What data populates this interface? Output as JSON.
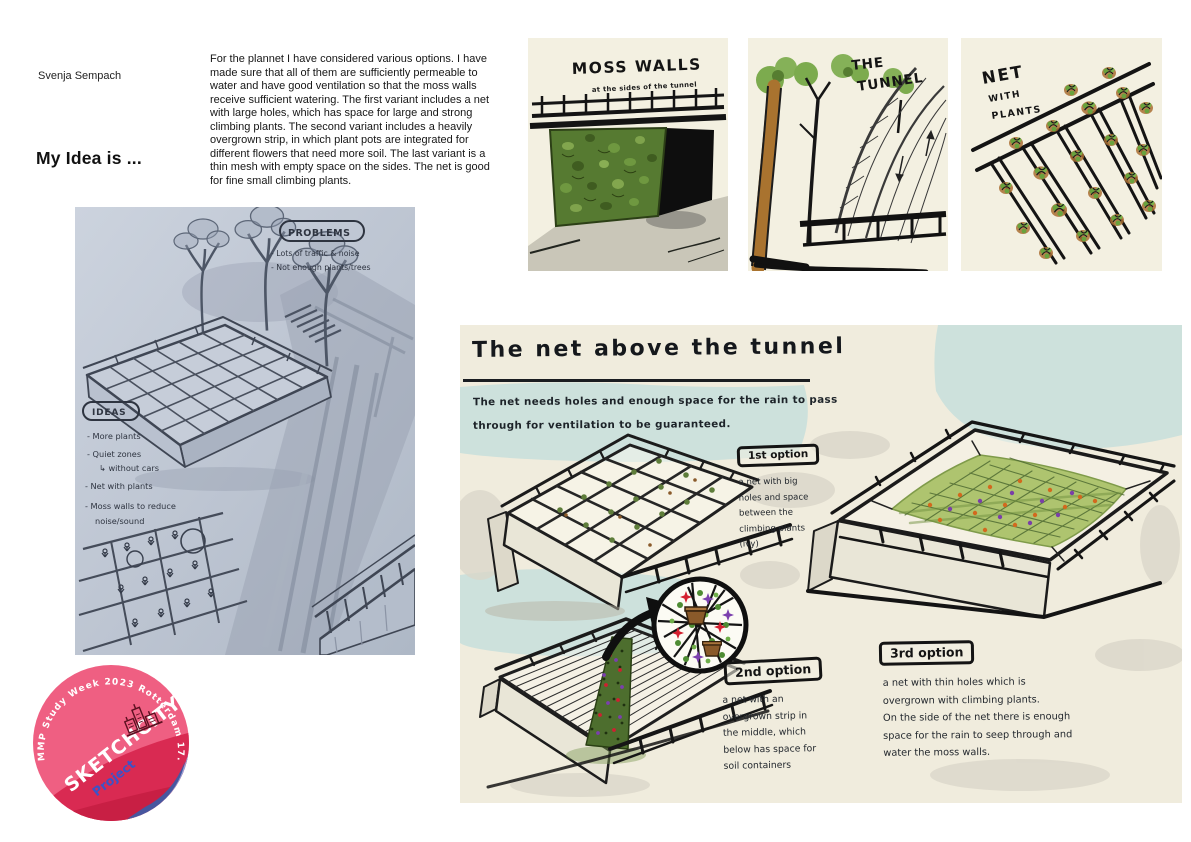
{
  "page": {
    "author": "Svenja Sempach",
    "heading": "My Idea is ...",
    "intro": "For the plannet I have considered various options. I have made sure that all of them are sufficiently permeable to water and have good ventilation so that the moss walls receive sufficient watering. The first variant includes a net with large holes, which has space for large and strong climbing plants. The second variant includes a heavily overgrown strip, in which plant pots are integrated for different flowers that need more soil. The last variant is a thin mesh with empty space on the sides. The net is good for fine small climbing plants."
  },
  "sketch": {
    "problems_title": "PROBLEMS",
    "problems": [
      "- Lots of traffic & noise",
      "- Not enough plants/trees"
    ],
    "ideas_title": "IDEAS",
    "ideas": [
      "- More plants",
      "- Quiet zones",
      "↳ without cars",
      "- Net with plants",
      "- Moss walls to reduce",
      "noise/sound"
    ]
  },
  "panels": {
    "moss": {
      "title": "MOSS WALLS",
      "subtitle": "at the sides of the tunnel"
    },
    "tunnel": {
      "line1": "THE",
      "line2": "TUNNEL"
    },
    "net": {
      "line1": "NET",
      "line2": "WITH",
      "line3": "PLANTS"
    }
  },
  "main": {
    "title": "The net above the tunnel",
    "subtitle1": "The net needs holes and enough space for the rain to pass",
    "subtitle2": "through for ventilation to be guaranteed.",
    "option1": {
      "label": "1st option",
      "lines": [
        "a net with big",
        "holes and space",
        "between the",
        "climbing plants",
        "(ivy)"
      ]
    },
    "option2": {
      "label": "2nd option",
      "lines": [
        "a net with an",
        "overgrown strip in",
        "the middle, which",
        "below has space for",
        "soil containers"
      ]
    },
    "option3": {
      "label": "3rd option",
      "lines": [
        "a net with thin holes which is",
        "overgrown with climbing plants.",
        "On the side of the net there is enough",
        "space for the rain to seep through and",
        "water the moss walls."
      ]
    }
  },
  "sticker": {
    "arc_text": "MMP Study Week 2023 Rotterdam 17.4.-21.4.2023",
    "title": "SKETCHCITY",
    "subtitle": "Project"
  },
  "colors": {
    "panel_bg": "#f3f0e1",
    "main_bg": "#f0ecdd",
    "teal": "#cde1dc",
    "moss_green": "#567a31",
    "net_green": "#aec46f",
    "sticker_pink": "#ee4568",
    "sticker_red": "#c81f44",
    "sticker_blue": "#4a5ba5",
    "project_blue": "#3d53c6"
  }
}
